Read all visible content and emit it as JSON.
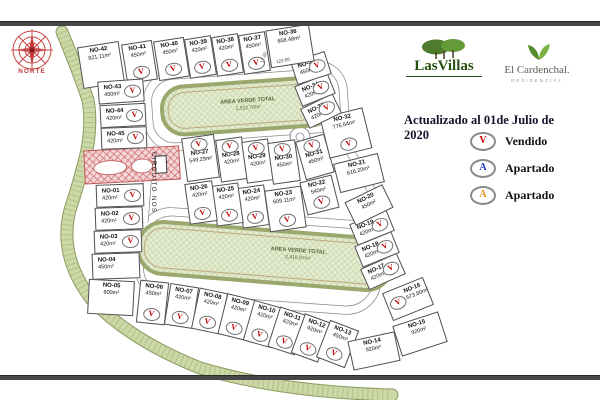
{
  "map": {
    "compass_label": "NORTE",
    "street_label": "CIRCUITO NOS",
    "vendido_symbol": "V",
    "marker_color": "#c40000",
    "road_labels": [
      "17.20",
      "122.06"
    ],
    "green_areas": [
      {
        "label": "AREA VERDE TOTAL",
        "area": "1,522.70m²"
      },
      {
        "label": "AREA VERDE TOTAL",
        "area": "2,416.07m²"
      }
    ],
    "lots": [
      {
        "id": "NO-01",
        "area": "420m²",
        "v": true,
        "x": 96,
        "y": 184,
        "w": 48,
        "h": 23,
        "r": -2,
        "mp": "right"
      },
      {
        "id": "NO-02",
        "area": "420m²",
        "v": true,
        "x": 95,
        "y": 207,
        "w": 48,
        "h": 23,
        "r": -2,
        "mp": "right"
      },
      {
        "id": "NO-03",
        "area": "420m²",
        "v": true,
        "x": 94,
        "y": 230,
        "w": 48,
        "h": 23,
        "r": -2,
        "mp": "right"
      },
      {
        "id": "NO-04",
        "area": "450m²",
        "v": false,
        "x": 92,
        "y": 253,
        "w": 48,
        "h": 26,
        "r": -2,
        "mp": "right"
      },
      {
        "id": "NO-05",
        "area": "600m²",
        "v": false,
        "x": 88,
        "y": 280,
        "w": 46,
        "h": 35,
        "r": 3,
        "mp": "bottom"
      },
      {
        "id": "NO-06",
        "area": "450m²",
        "v": true,
        "x": 138,
        "y": 281,
        "w": 29,
        "h": 43,
        "r": 6,
        "mp": "bottom"
      },
      {
        "id": "NO-07",
        "area": "420m²",
        "v": true,
        "x": 167,
        "y": 285,
        "w": 29,
        "h": 42,
        "r": 9,
        "mp": "bottom"
      },
      {
        "id": "NO-08",
        "area": "420m²",
        "v": true,
        "x": 195,
        "y": 290,
        "w": 29,
        "h": 42,
        "r": 12,
        "mp": "bottom"
      },
      {
        "id": "NO-09",
        "area": "420m²",
        "v": true,
        "x": 222,
        "y": 296,
        "w": 29,
        "h": 42,
        "r": 14,
        "mp": "bottom"
      },
      {
        "id": "NO-10",
        "area": "420m²",
        "v": true,
        "x": 248,
        "y": 303,
        "w": 29,
        "h": 42,
        "r": 16,
        "mp": "bottom"
      },
      {
        "id": "NO-11",
        "area": "420m²",
        "v": true,
        "x": 273,
        "y": 310,
        "w": 29,
        "h": 42,
        "r": 18,
        "mp": "bottom"
      },
      {
        "id": "NO-12",
        "area": "420m²",
        "v": true,
        "x": 297,
        "y": 317,
        "w": 29,
        "h": 42,
        "r": 20,
        "mp": "bottom"
      },
      {
        "id": "NO-13",
        "area": "450m²",
        "v": true,
        "x": 322,
        "y": 324,
        "w": 31,
        "h": 40,
        "r": 21,
        "mp": "bottom"
      },
      {
        "id": "NO-14",
        "area": "920m²",
        "v": false,
        "x": 350,
        "y": 336,
        "w": 48,
        "h": 30,
        "r": -12,
        "mp": "bottom"
      },
      {
        "id": "NO-15",
        "area": "920m²",
        "v": false,
        "x": 396,
        "y": 318,
        "w": 48,
        "h": 32,
        "r": -18,
        "mp": "bottom"
      },
      {
        "id": "NO-16",
        "area": "573.80m²",
        "v": true,
        "x": 386,
        "y": 284,
        "w": 44,
        "h": 30,
        "r": -22,
        "mp": "left"
      },
      {
        "id": "NO-17",
        "area": "420m²",
        "v": true,
        "x": 363,
        "y": 260,
        "w": 40,
        "h": 23,
        "r": -24,
        "mp": "right"
      },
      {
        "id": "NO-18",
        "area": "420m²",
        "v": true,
        "x": 357,
        "y": 238,
        "w": 40,
        "h": 23,
        "r": -22,
        "mp": "right"
      },
      {
        "id": "NO-19",
        "area": "420m²",
        "v": true,
        "x": 352,
        "y": 216,
        "w": 40,
        "h": 23,
        "r": -22,
        "mp": "right"
      },
      {
        "id": "NO-20",
        "area": "450m²",
        "v": false,
        "x": 348,
        "y": 192,
        "w": 42,
        "h": 26,
        "r": -26,
        "mp": "bottom"
      },
      {
        "id": "NO-21",
        "area": "616.20m²",
        "v": false,
        "x": 336,
        "y": 158,
        "w": 46,
        "h": 30,
        "r": -14,
        "mp": "bottom"
      },
      {
        "id": "NO-22",
        "area": "540m²",
        "v": true,
        "x": 303,
        "y": 178,
        "w": 33,
        "h": 34,
        "r": -14,
        "mp": "bottom"
      },
      {
        "id": "NO-23",
        "area": "609.11m²",
        "v": true,
        "x": 267,
        "y": 188,
        "w": 37,
        "h": 42,
        "r": -8,
        "mp": "bottom"
      },
      {
        "id": "NO-24",
        "area": "420m²",
        "v": true,
        "x": 240,
        "y": 186,
        "w": 27,
        "h": 41,
        "r": -8,
        "mp": "bottom"
      },
      {
        "id": "NO-25",
        "area": "420m²",
        "v": true,
        "x": 214,
        "y": 184,
        "w": 27,
        "h": 41,
        "r": -8,
        "mp": "bottom"
      },
      {
        "id": "NO-26",
        "area": "420m²",
        "v": true,
        "x": 187,
        "y": 182,
        "w": 28,
        "h": 41,
        "r": -8,
        "mp": "bottom"
      },
      {
        "id": "NO-27",
        "area": "549.29m²",
        "v": true,
        "x": 184,
        "y": 136,
        "w": 33,
        "h": 44,
        "r": -8,
        "mp": "top"
      },
      {
        "id": "NO-28",
        "area": "420m²",
        "v": true,
        "x": 218,
        "y": 138,
        "w": 27,
        "h": 43,
        "r": -8,
        "mp": "top"
      },
      {
        "id": "NO-29",
        "area": "420m²",
        "v": true,
        "x": 244,
        "y": 140,
        "w": 27,
        "h": 42,
        "r": -8,
        "mp": "top"
      },
      {
        "id": "NO-30",
        "area": "450m²",
        "v": true,
        "x": 270,
        "y": 141,
        "w": 28,
        "h": 42,
        "r": -8,
        "mp": "top"
      },
      {
        "id": "NO-31",
        "area": "450m²",
        "v": true,
        "x": 300,
        "y": 137,
        "w": 30,
        "h": 40,
        "r": -16,
        "mp": "top"
      },
      {
        "id": "NO-32",
        "area": "776.64m²",
        "v": true,
        "x": 324,
        "y": 112,
        "w": 44,
        "h": 42,
        "r": -14,
        "mp": "bottom"
      },
      {
        "id": "NO-33",
        "area": "420m²",
        "v": true,
        "x": 303,
        "y": 100,
        "w": 36,
        "h": 22,
        "r": -26,
        "mp": "right"
      },
      {
        "id": "NO-34",
        "area": "420m²",
        "v": true,
        "x": 297,
        "y": 79,
        "w": 36,
        "h": 22,
        "r": -22,
        "mp": "right"
      },
      {
        "id": "NO-35",
        "area": "450m²",
        "v": true,
        "x": 293,
        "y": 56,
        "w": 36,
        "h": 24,
        "r": -18,
        "mp": "right"
      },
      {
        "id": "NO-36",
        "area": "658.48m²",
        "v": false,
        "x": 268,
        "y": 27,
        "w": 44,
        "h": 38,
        "r": -9,
        "mp": "bottom"
      },
      {
        "id": "NO-37",
        "area": "450m²",
        "v": true,
        "x": 241,
        "y": 33,
        "w": 27,
        "h": 40,
        "r": -9,
        "mp": "bottom"
      },
      {
        "id": "NO-38",
        "area": "420m²",
        "v": true,
        "x": 214,
        "y": 35,
        "w": 27,
        "h": 40,
        "r": -9,
        "mp": "bottom"
      },
      {
        "id": "NO-39",
        "area": "420m²",
        "v": true,
        "x": 187,
        "y": 37,
        "w": 27,
        "h": 40,
        "r": -9,
        "mp": "bottom"
      },
      {
        "id": "NO-40",
        "area": "450m²",
        "v": true,
        "x": 156,
        "y": 39,
        "w": 31,
        "h": 40,
        "r": -9,
        "mp": "bottom"
      },
      {
        "id": "NO-41",
        "area": "450m²",
        "v": true,
        "x": 124,
        "y": 42,
        "w": 31,
        "h": 40,
        "r": -9,
        "mp": "bottom"
      },
      {
        "id": "NO-42",
        "area": "821.11m²",
        "v": false,
        "x": 80,
        "y": 44,
        "w": 42,
        "h": 42,
        "r": -9,
        "mp": "bottom"
      },
      {
        "id": "NO-43",
        "area": "450m²",
        "v": true,
        "x": 98,
        "y": 80,
        "w": 46,
        "h": 23,
        "r": -4,
        "mp": "right"
      },
      {
        "id": "NO-44",
        "area": "420m²",
        "v": true,
        "x": 100,
        "y": 104,
        "w": 46,
        "h": 23,
        "r": -3,
        "mp": "right"
      },
      {
        "id": "NO-45",
        "area": "420m²",
        "v": true,
        "x": 101,
        "y": 127,
        "w": 46,
        "h": 22,
        "r": -2,
        "mp": "right"
      }
    ]
  },
  "panel": {
    "brand1": {
      "name": "LasVillas"
    },
    "brand2": {
      "name": "El Cardenchal.",
      "sub": "RESIDENCIAL"
    },
    "updated": "Actualizado al 01de Julio de 2020",
    "legend": [
      {
        "symbol": "V",
        "label": "Vendido",
        "color": "#c40000"
      },
      {
        "symbol": "A",
        "label": "Apartado",
        "color": "#2238bb"
      },
      {
        "symbol": "A",
        "label": "Apartado",
        "color": "#e8941a"
      }
    ]
  }
}
